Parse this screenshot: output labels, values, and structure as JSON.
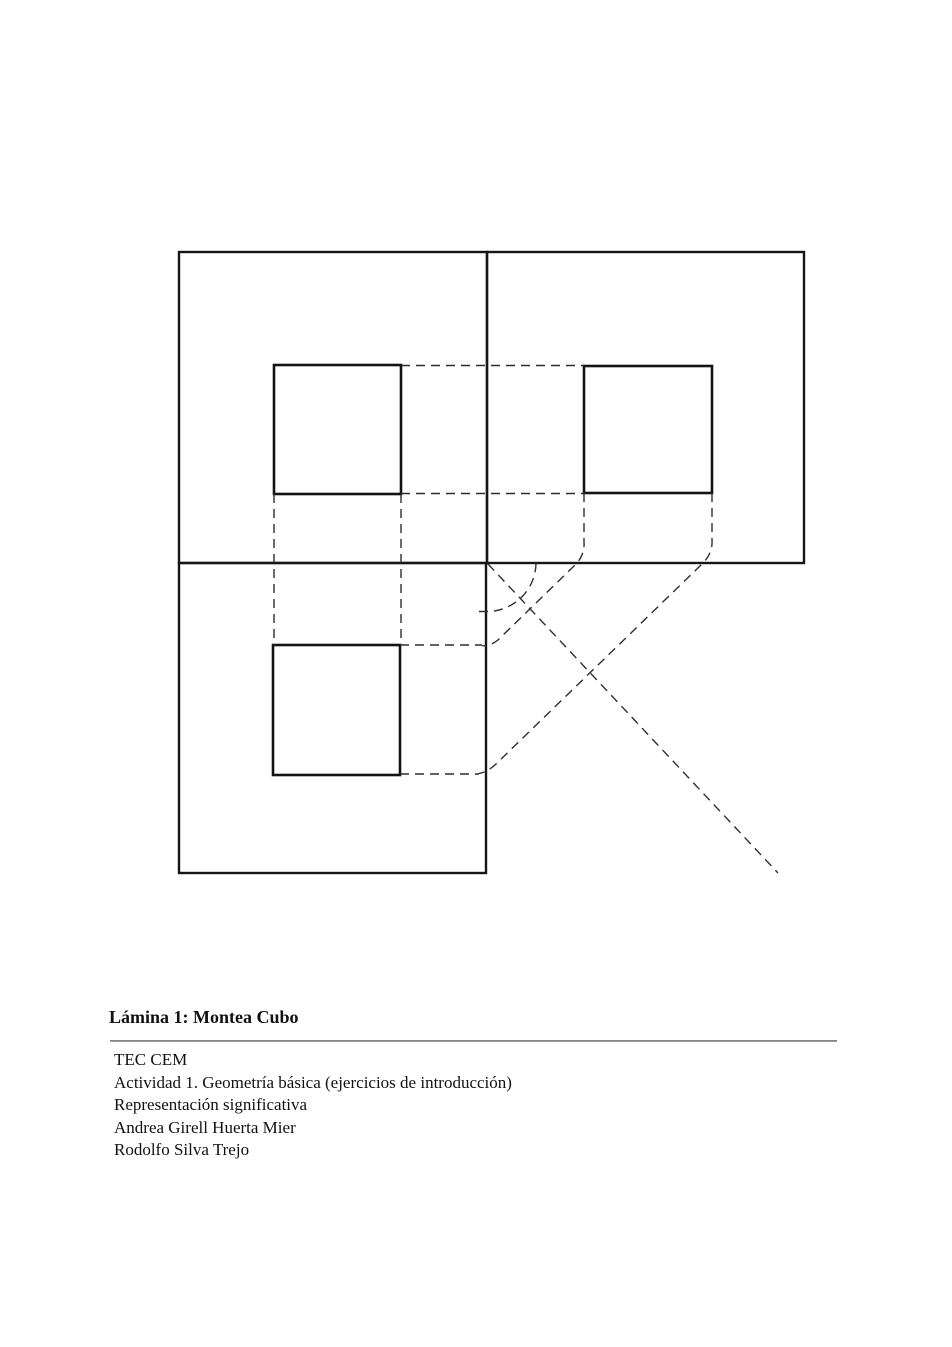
{
  "document": {
    "caption_title": "Lámina 1: Montea Cubo",
    "credits": [
      "TEC CEM",
      "Actividad 1. Geometría básica (ejercicios de introducción)",
      "Representación significativa",
      "Andrea Girell Huerta Mier",
      "Rodolfo Silva Trejo"
    ]
  },
  "figure": {
    "description": "Montea of a cube: three orthographic view rectangles, each with an inner square, joined by dashed projection lines, a 45-degree miter line and a transfer arc",
    "colors": {
      "background": "#ffffff",
      "solid_line": "#161616",
      "dashed_line": "#2e2e2e",
      "divider": "#9a9a9a"
    }
  }
}
